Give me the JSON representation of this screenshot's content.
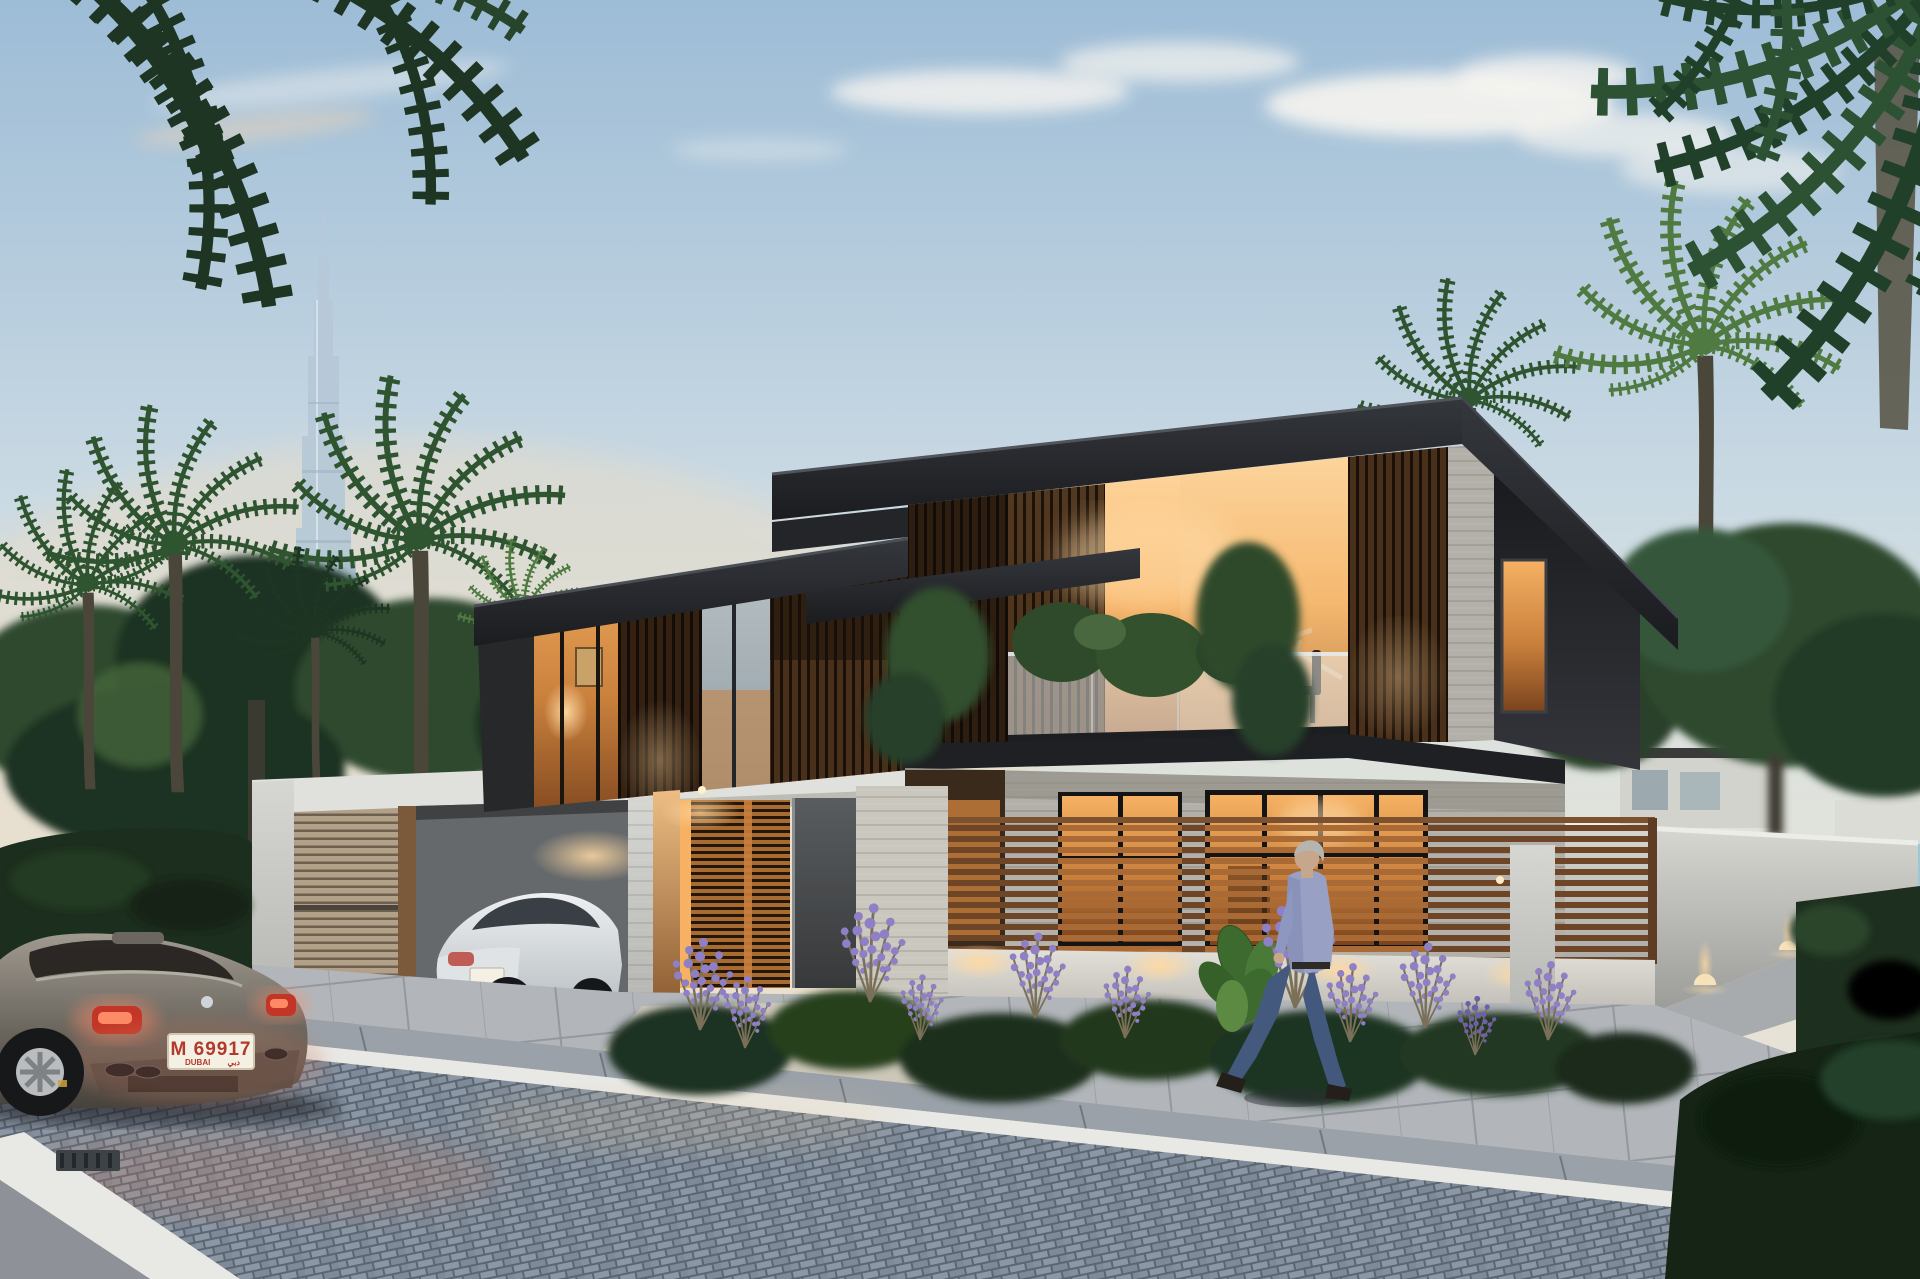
{
  "scene": {
    "setting": "Dusk street view of a modern two-storey luxury villa with warm interior lighting, Burj Khalifa on the skyline and the sea at the right horizon",
    "landmark": "Burj Khalifa",
    "objects": [
      {
        "id": "burj-khalifa-tower",
        "label": "Burj Khalifa skyscraper on the horizon"
      },
      {
        "id": "villa",
        "label": "Modern flat-roof villa with wood slat cladding and glass walls"
      },
      {
        "id": "balcony",
        "label": "First-floor glass balcony with plants and warm lit interior"
      },
      {
        "id": "carport",
        "label": "Walled carport with wooden slat screen"
      },
      {
        "id": "bentley-car",
        "label": "White luxury coupe parked in the carport"
      },
      {
        "id": "mercedes-car",
        "label": "Gray gullwing coupe with lit taillights on the street"
      },
      {
        "id": "walking-man",
        "label": "Gray-haired man in a blue shirt and jeans walking on the sidewalk"
      },
      {
        "id": "entrance-door",
        "label": "Dark entrance door with backlit wooden slat screens"
      },
      {
        "id": "slat-fence",
        "label": "Horizontal wooden slat privacy fence"
      },
      {
        "id": "garden-bed",
        "label": "Planting bed with shrubs and purple lavender, uplit"
      },
      {
        "id": "right-perimeter-wall",
        "label": "Concrete perimeter wall with dome uplights"
      },
      {
        "id": "palm-trees",
        "label": "Palm trees framing the scene"
      },
      {
        "id": "sea",
        "label": "Sea visible at the right horizon"
      },
      {
        "id": "road",
        "label": "Cobblestone street with white curb and paver sidewalk"
      },
      {
        "id": "storm-drain",
        "label": "Drain grate at the street corner"
      }
    ]
  },
  "license_plate": {
    "code": "M 69917",
    "city": "DUBAI",
    "city_arabic": "دبي"
  },
  "palette": {
    "sky-top": "#9dbcd6",
    "sky-mid": "#c9d9e3",
    "sky-low": "#e6e3d8",
    "sky-warm": "#f1ddc0",
    "cloud": "#f7f5f0",
    "sea": "#9ec7d6",
    "burj": "#b7c9d8",
    "tree-dark": "#1f3322",
    "tree-mid": "#2d4a2e",
    "tree-light": "#44653c",
    "palm-dark": "#1d3522",
    "palm-mid": "#2f5430",
    "palm-light": "#4f7a41",
    "roof": "#232428",
    "wood-dark": "#5c3a22",
    "wood-mid": "#8a5a33",
    "wood-warm": "#c9803c",
    "glass-warm-hi": "#f6b163",
    "glass-warm-lo": "#7a431d",
    "stone-light": "#cac7bf",
    "stone-mid": "#b2b0a8",
    "wall-white": "#e0e1dc",
    "fence-wood": "#6f4527",
    "fence-wood-lit": "#aa6a36",
    "slat-garage": "#b2a089",
    "road": "#8b97a4",
    "road-joint": "#5c6673",
    "sidewalk": "#b2b6ba",
    "curb": "#e8e8e4",
    "curbstone": "#9aa1a8",
    "car-body": "#8f8a82",
    "tail-red": "#c33526",
    "tail-glow": "#ff8a66",
    "plate-bg": "#f4f0e3",
    "plate-red": "#b23a2c",
    "bentley": "#dfe3e6",
    "man-shirt": "#98a0c4",
    "man-jeans": "#42587d",
    "skin": "#c6a78c",
    "hair": "#b6b4ae",
    "lavender": "#8f7fc4",
    "uplight": "#ffd9a2"
  }
}
